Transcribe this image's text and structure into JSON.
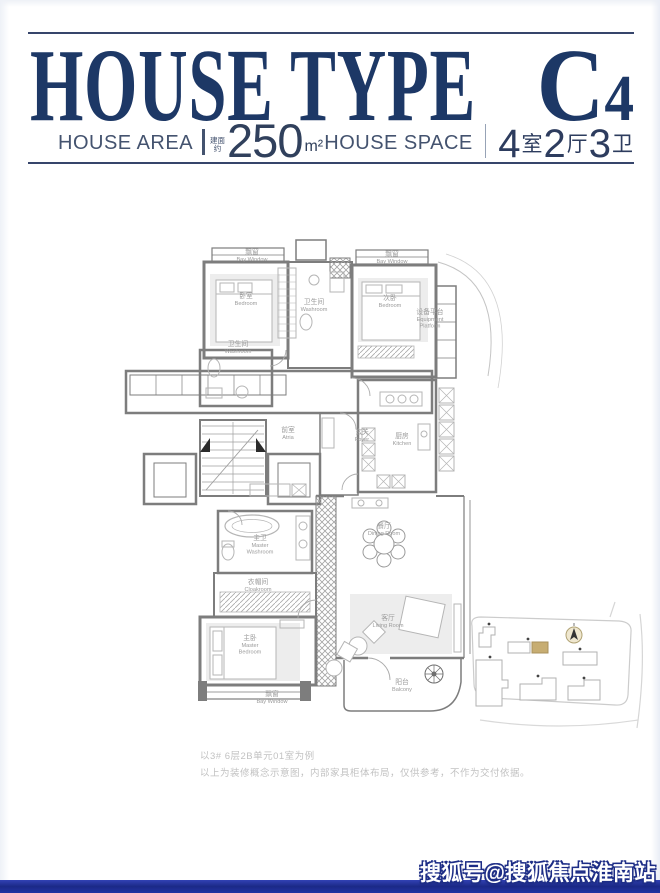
{
  "page": {
    "watermark": "搜狐号@搜狐焦点淮南站"
  },
  "colors": {
    "title_navy": "#1d3866",
    "rule_navy": "#36456b",
    "bottom_bar_blue": "#1f2f9e",
    "highlight_building_tan": "#c7ad72",
    "wall_gray": "#7d7d7d"
  },
  "header": {
    "title_main": "HOUSE TYPE",
    "title_code": "C",
    "title_code_sub": "4",
    "area": {
      "label": "HOUSE AREA",
      "prefix_line1": "建面",
      "prefix_line2": "约",
      "value": "250",
      "unit": "m²"
    },
    "space": {
      "label": "HOUSE SPACE",
      "n1": "4",
      "u1": "室",
      "n2": "2",
      "u2": "厅",
      "n3": "3",
      "u3": "卫"
    }
  },
  "floorplan": {
    "rooms": [
      {
        "id": "bay-window-1",
        "cn": "飘窗",
        "en": "Bay Window",
        "x": 152,
        "y": 26
      },
      {
        "id": "bedroom-1",
        "cn": "卧室",
        "en": "Bedroom",
        "x": 146,
        "y": 70
      },
      {
        "id": "washroom-1",
        "cn": "卫生间",
        "en": "Washroom",
        "x": 214,
        "y": 76
      },
      {
        "id": "bay-window-2",
        "cn": "飘窗",
        "en": "Bay Window",
        "x": 292,
        "y": 28
      },
      {
        "id": "bedroom-2",
        "cn": "次卧",
        "en": "Bedroom",
        "x": 290,
        "y": 72
      },
      {
        "id": "equipment-platform",
        "cn": "设备平台",
        "en": "Equipment",
        "en2": "Platform",
        "x": 330,
        "y": 86
      },
      {
        "id": "washroom-2",
        "cn": "卫生间",
        "en": "Washroom",
        "x": 138,
        "y": 118
      },
      {
        "id": "atria",
        "cn": "前室",
        "en": "Atria",
        "x": 188,
        "y": 204
      },
      {
        "id": "foyer",
        "cn": "玄关",
        "en": "Foyer",
        "x": 262,
        "y": 206
      },
      {
        "id": "kitchen",
        "cn": "厨房",
        "en": "Kitchen",
        "x": 302,
        "y": 210
      },
      {
        "id": "master-washroom",
        "cn": "主卫",
        "en": "Master",
        "en2": "Washroom",
        "x": 160,
        "y": 312
      },
      {
        "id": "cloakroom",
        "cn": "衣帽间",
        "en": "Cloakroom",
        "x": 158,
        "y": 356
      },
      {
        "id": "dining-room",
        "cn": "餐厅",
        "en": "Dining Room",
        "x": 284,
        "y": 300
      },
      {
        "id": "living-room",
        "cn": "客厅",
        "en": "Living Room",
        "x": 288,
        "y": 392
      },
      {
        "id": "master-bedroom",
        "cn": "主卧",
        "en": "Master",
        "en2": "Bedroom",
        "x": 150,
        "y": 412
      },
      {
        "id": "bay-window-3",
        "cn": "飘窗",
        "en": "Bay Window",
        "x": 172,
        "y": 468
      },
      {
        "id": "balcony",
        "cn": "阳台",
        "en": "Balcony",
        "x": 302,
        "y": 456
      }
    ]
  },
  "disclaimer": {
    "line1": "以3# 6层2B单元01室为例",
    "line2": "以上为装修概念示意图，内部家具柜体布局，仅供参考，不作为交付依据。"
  }
}
